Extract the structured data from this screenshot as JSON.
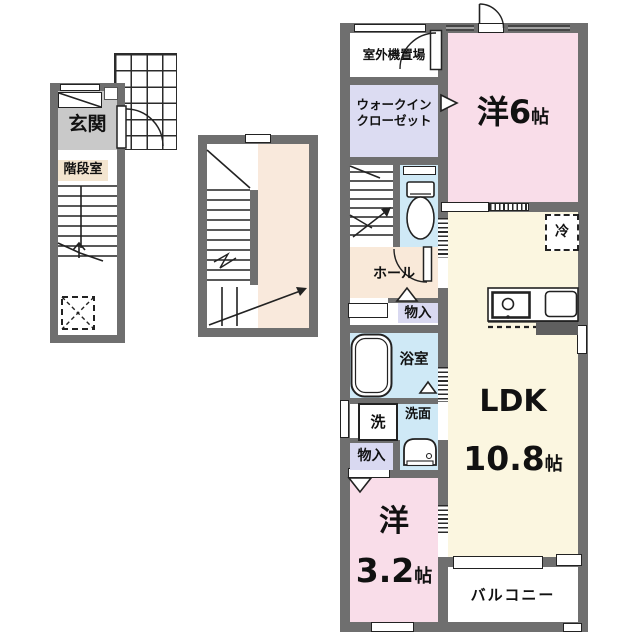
{
  "title": "2F maisonette floor plan",
  "colors": {
    "wall": "#6f6f6f",
    "bedroom_pink": "#f9dde9",
    "closet_lavender": "#dcdcf2",
    "wet_area_blue": "#cfe9f6",
    "hall_peach": "#f9e9d9",
    "ldk_cream": "#fbf6e0",
    "entrance_gray": "#c9c9c9",
    "stair_beige": "#f3e5d0",
    "landing_beige": "#f9e9dc"
  },
  "floor1": {
    "entrance_label": "玄関",
    "stairwell_label": "階段室"
  },
  "unit2f": {
    "outdoor_unit_label": "室外機置場",
    "wic_line1": "ウォークイン",
    "wic_line2": "クローゼット",
    "bedroom6": {
      "name": "洋6",
      "unit": "帖"
    },
    "hall_label": "ホール",
    "hall_storage_label": "物入",
    "bath_label": "浴室",
    "washer_label": "洗",
    "washroom_label": "洗面",
    "fridge_label": "冷",
    "ldk": {
      "name": "LDK",
      "size": "10.8",
      "unit": "帖"
    },
    "bedroom32": {
      "name": "洋",
      "size": "3.2",
      "unit": "帖"
    },
    "storage_label": "物入",
    "balcony_label": "バルコニー"
  }
}
